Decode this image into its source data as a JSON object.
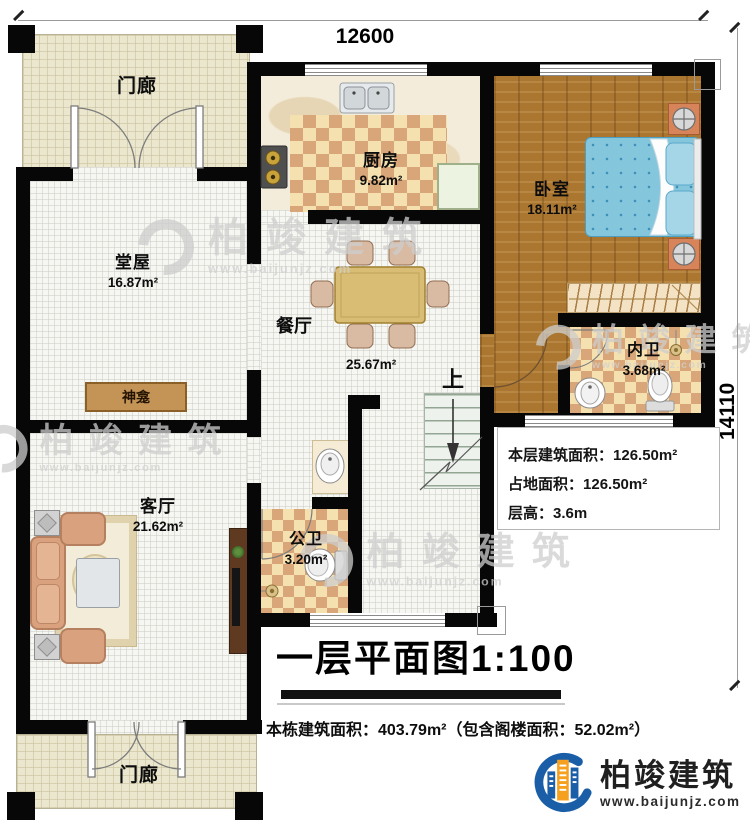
{
  "title_block": {
    "text": "一层平面图1:100"
  },
  "dimensions": {
    "top_width": "12600",
    "right_height": "14110"
  },
  "rooms": {
    "porch_top": {
      "name": "门廊"
    },
    "porch_bottom": {
      "name": "门廊"
    },
    "hall": {
      "name": "堂屋",
      "area": "16.87m²"
    },
    "kitchen": {
      "name": "厨房",
      "area": "9.82m²"
    },
    "bedroom": {
      "name": "卧室",
      "area": "18.11m²"
    },
    "dining": {
      "name": "餐厅",
      "area": "25.67m²"
    },
    "living": {
      "name": "客厅",
      "area": "21.62m²"
    },
    "master_bath": {
      "name": "内卫",
      "area": "3.68m²"
    },
    "public_bath": {
      "name": "公卫",
      "area": "3.20m²"
    }
  },
  "features": {
    "shrine": "神龛",
    "stairs_up": "上"
  },
  "stats": [
    {
      "label": "本层建筑面积：",
      "value": "126.50m²"
    },
    {
      "label": "占地面积：",
      "value": "126.50m²"
    },
    {
      "label": "层高：",
      "value": "3.6m"
    }
  ],
  "footer": {
    "building_total": "本栋建筑面积：403.79m²（包含阁楼面积：52.02m²）"
  },
  "brand": {
    "name": "柏竣建筑",
    "website": "www.baijunjz.com"
  },
  "watermark": {
    "name": "柏竣建筑",
    "website": "www.baijunjz.com"
  },
  "colors": {
    "wall": "#070707",
    "brand_blue": "#1b5ea8",
    "brand_orange": "#f5a01e",
    "checker_tan": "#d8a678",
    "wood": "#ab7730",
    "bed_blue": "#84c6dc",
    "porch": "#ebe7ce"
  }
}
